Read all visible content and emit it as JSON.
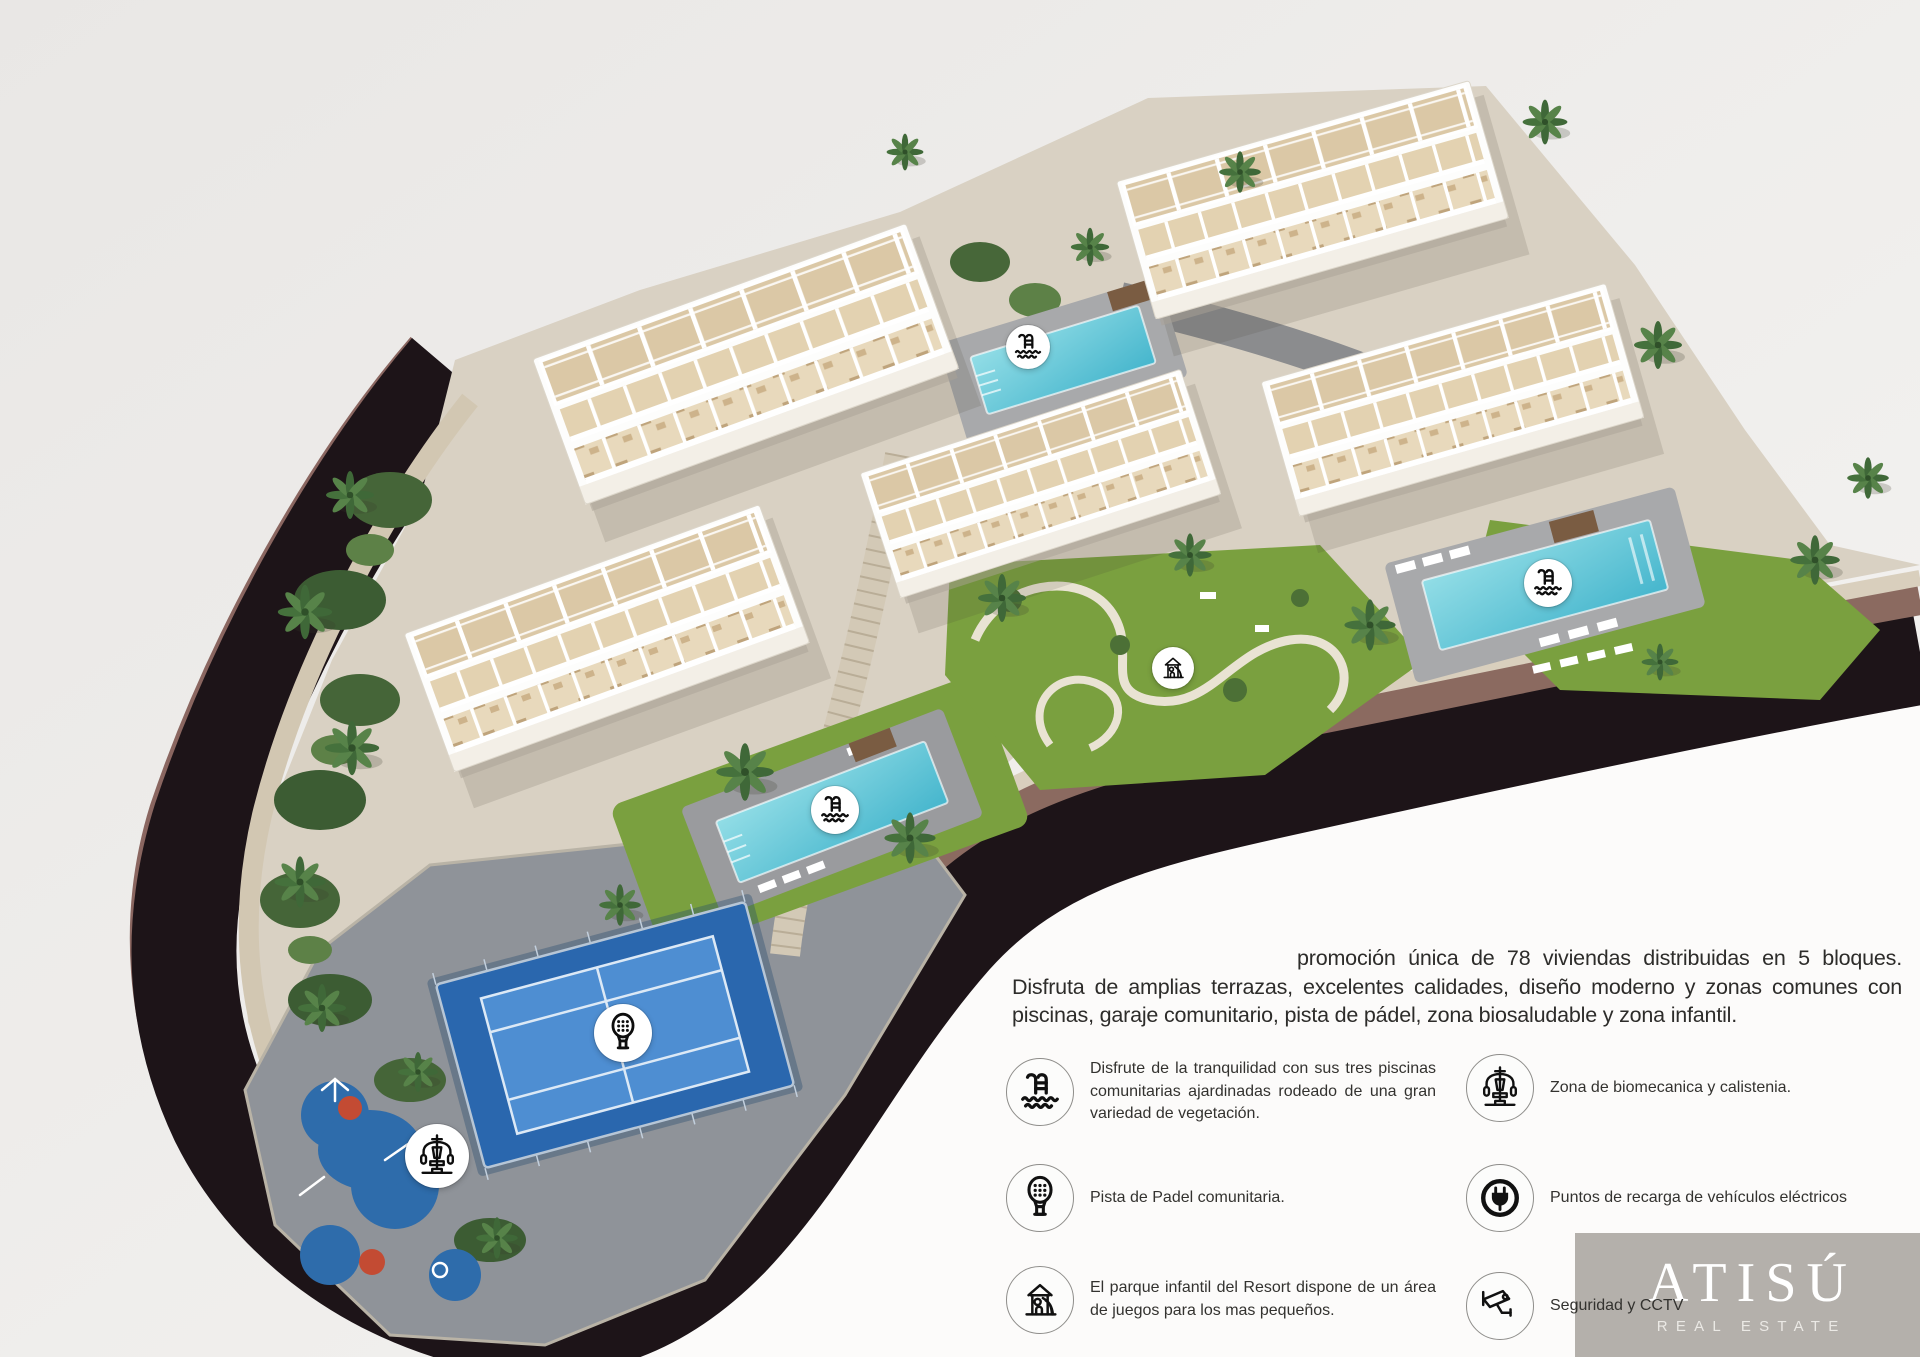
{
  "intro": {
    "text": "promoción única de 78 viviendas distribuidas en 5 bloques. Disfruta de amplias terrazas, excelentes calidades, diseño moderno y zonas comunes con piscinas, garaje comunitario, pista de pádel, zona biosaludable y zona infantil."
  },
  "features": {
    "left": [
      {
        "icon": "pool-icon",
        "text": "Disfrute de la tranquilidad con sus tres piscinas comunitarias ajardinadas rodeado de una gran variedad de vegetación."
      },
      {
        "icon": "padel-icon",
        "text": "Pista de Padel comunitaria."
      },
      {
        "icon": "playground-icon",
        "text": "El parque infantil del Resort dispone de un área de juegos para los mas pequeños."
      }
    ],
    "right": [
      {
        "icon": "biomechanics-icon",
        "text": "Zona de biomecanica y calistenia."
      },
      {
        "icon": "ev-charger-icon",
        "text": "Puntos de recarga de vehículos eléctricos"
      },
      {
        "icon": "cctv-icon",
        "text": "Seguridad y CCTV"
      }
    ]
  },
  "map_markers": [
    {
      "icon": "pool-icon"
    },
    {
      "icon": "pool-icon"
    },
    {
      "icon": "pool-icon"
    },
    {
      "icon": "playground-icon"
    },
    {
      "icon": "padel-icon"
    },
    {
      "icon": "biomechanics-icon"
    }
  ],
  "logo": {
    "name": "ATISÚ",
    "subtitle": "REAL ESTATE"
  },
  "colors": {
    "background": "#efedeb",
    "white_area": "#fcfbfa",
    "terrain_stone": "#d9d1c3",
    "band_dark": "#1d1418",
    "band_mauve": "#8a6660",
    "lawn": "#7aa03f",
    "water": "#6fcbdc",
    "padel_court": "#2a67ae",
    "playground_blue": "#2e6cab",
    "playground_red": "#c34b33",
    "logo_background": "#b4b0ab"
  }
}
